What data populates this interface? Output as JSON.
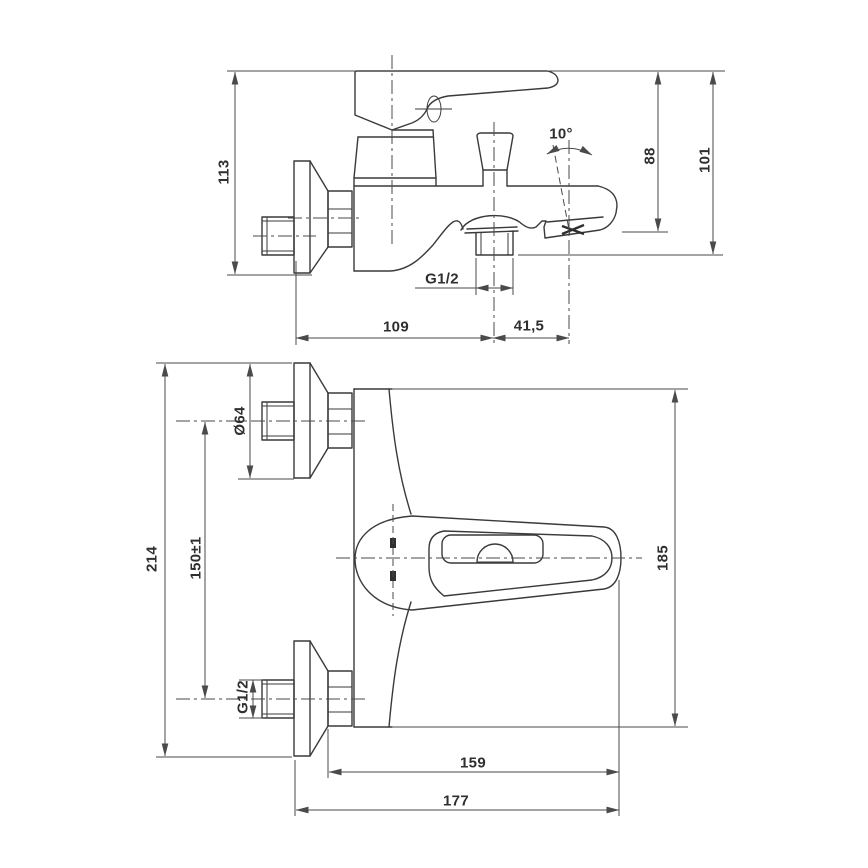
{
  "side": {
    "d113": "113",
    "d88": "88",
    "d101": "101",
    "angle": "10°",
    "thread": "G1/2",
    "d109": "109",
    "d41_5": "41,5"
  },
  "plan": {
    "d214": "214",
    "d150": "150±1",
    "dia": "Ø64",
    "thread": "G1/2",
    "d185": "185",
    "d159": "159",
    "d177": "177"
  },
  "style": {
    "line": "#3a3a3a",
    "text": "#2f2f2f",
    "background": "#ffffff"
  }
}
